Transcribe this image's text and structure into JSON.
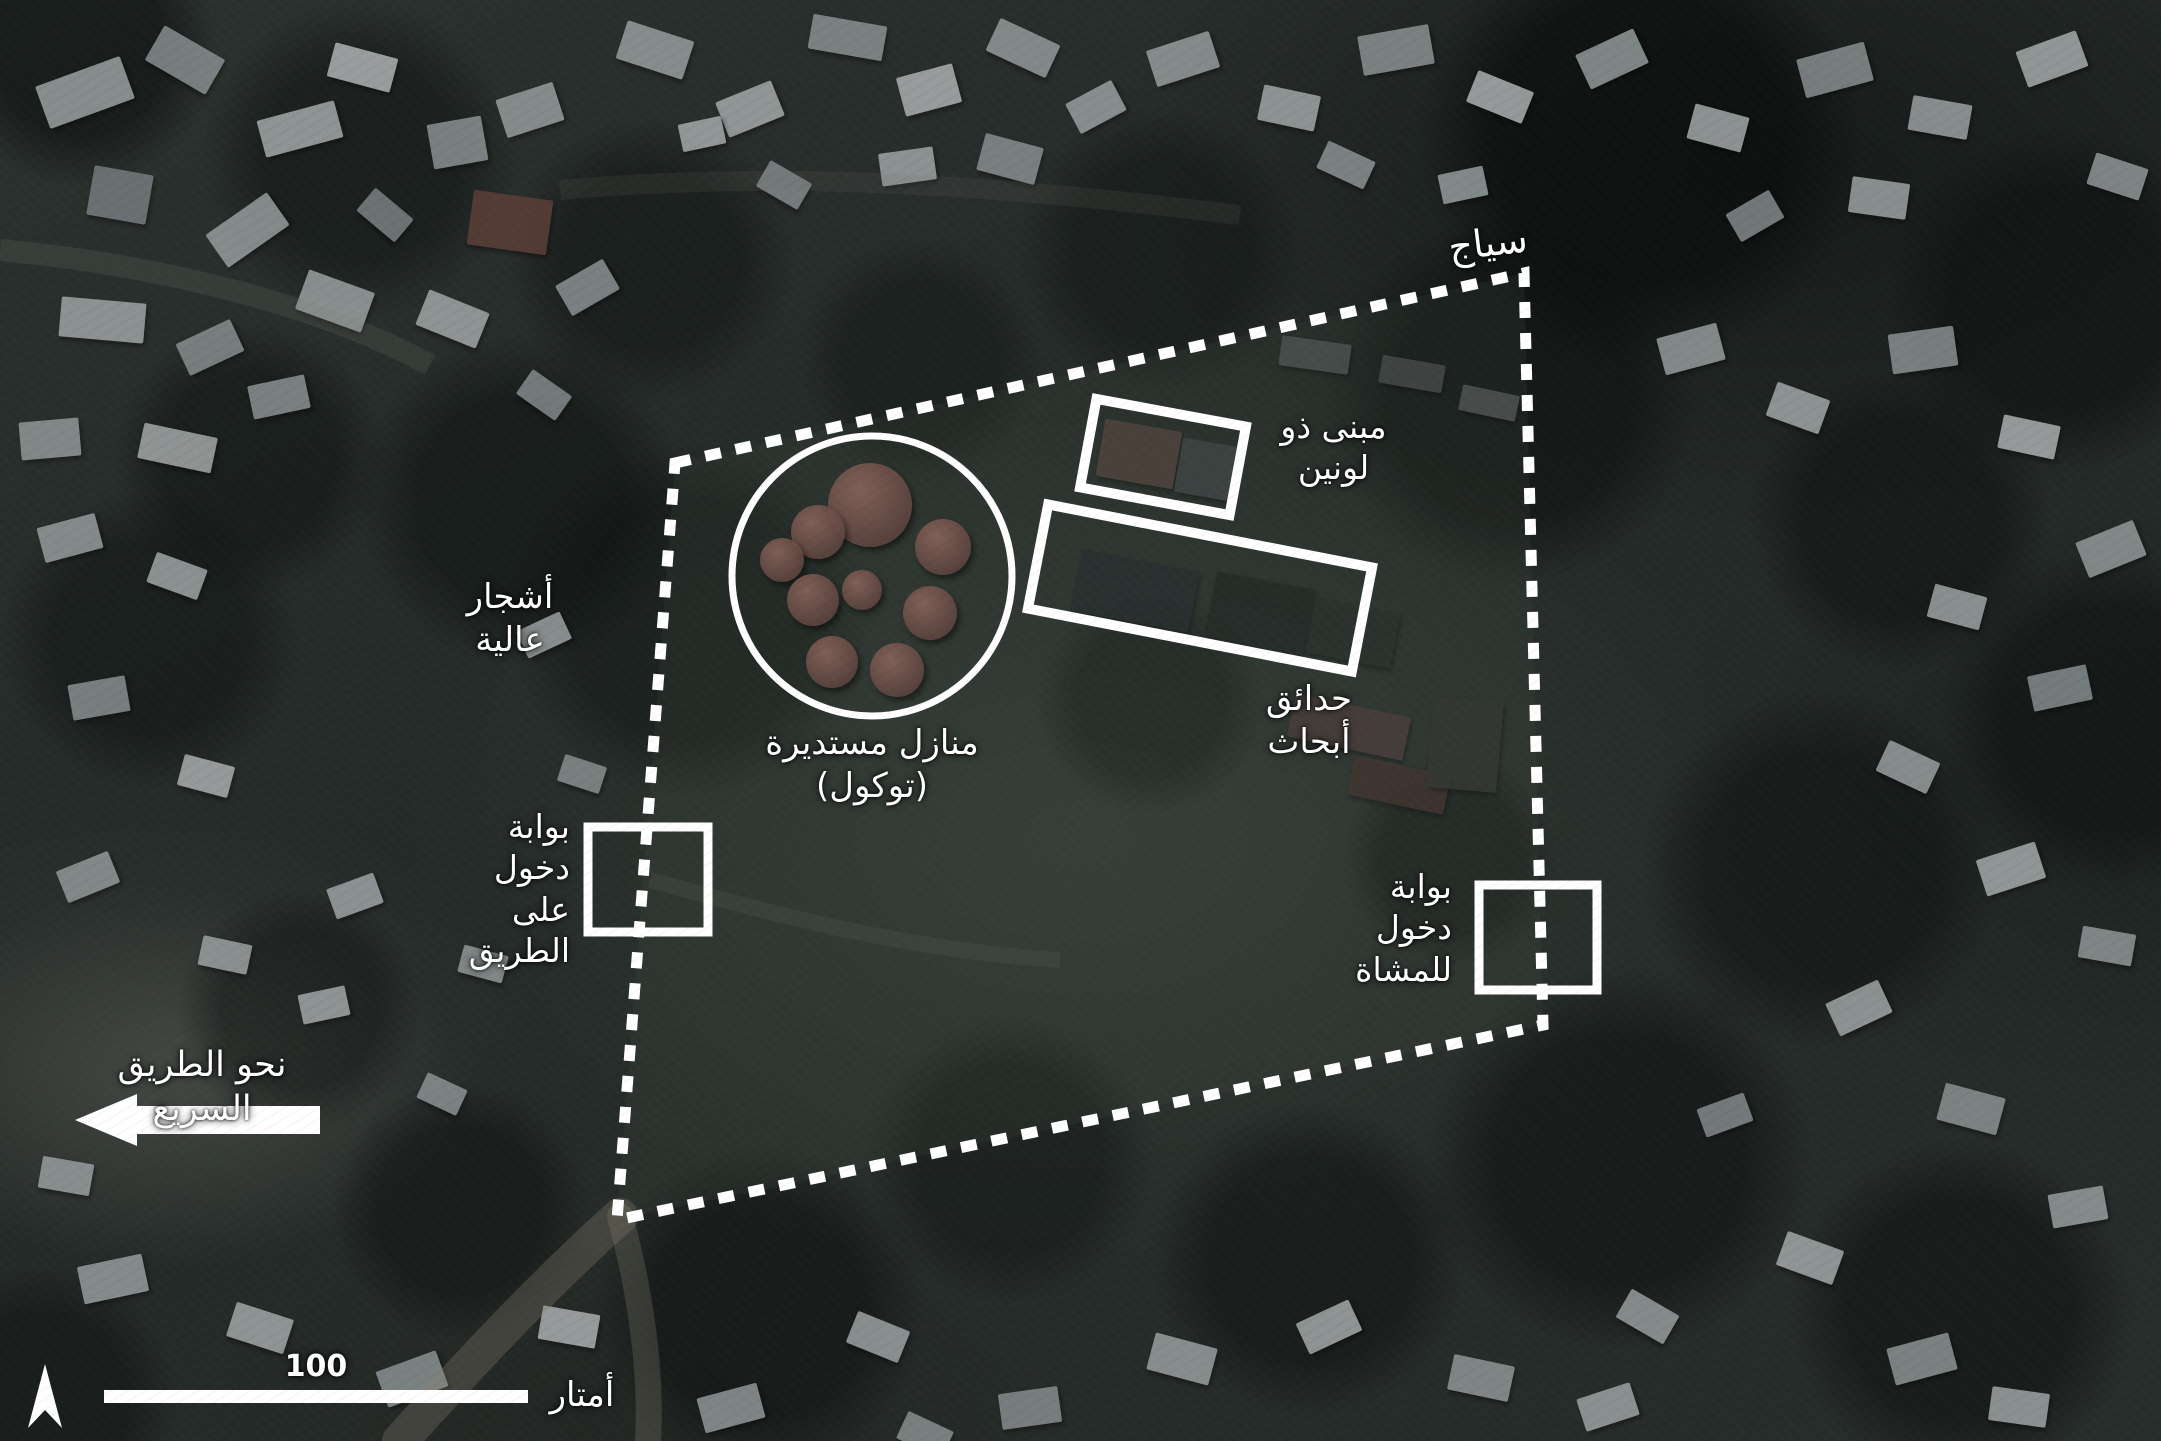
{
  "map": {
    "type": "annotated-satellite-image",
    "language": "ar",
    "annotation_color": "#ffffff",
    "labels": {
      "fence": "سياج",
      "two_tone_building": "مبنى ذو\nلونين",
      "tall_trees": "أشجار\nعالية",
      "round_houses": "منازل مستديرة\n(توكول)",
      "research_gardens": "حدائق\nأبحاث",
      "road_entrance_gate": "بوابة\nدخول على\nالطريق",
      "pedestrian_entrance_gate": "بوابة\nدخول\nللمشاة",
      "toward_highway": "نحو الطريق السريع"
    },
    "scale_bar": {
      "value": "100",
      "unit": "أمتار"
    }
  }
}
